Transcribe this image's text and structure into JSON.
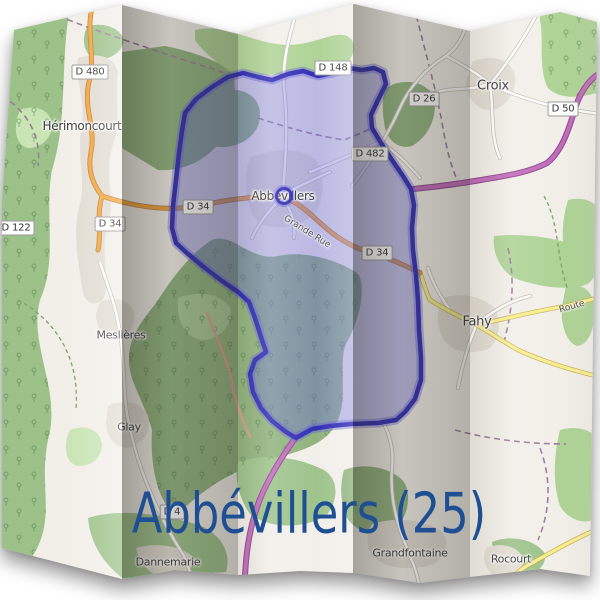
{
  "title": {
    "text": "Abbévillers (25)",
    "color": "#1f4f93"
  },
  "map": {
    "towns": [
      {
        "name": "Hérimoncourt",
        "x": 82,
        "y": 126,
        "size": 12
      },
      {
        "name": "Croix",
        "x": 493,
        "y": 86,
        "size": 13
      },
      {
        "name": "Abbévillers",
        "x": 283,
        "y": 196,
        "size": 12
      },
      {
        "name": "Meslières",
        "x": 121,
        "y": 335,
        "size": 11
      },
      {
        "name": "Glay",
        "x": 129,
        "y": 427,
        "size": 11
      },
      {
        "name": "Fahy",
        "x": 477,
        "y": 322,
        "size": 13
      },
      {
        "name": "Grandfontaine",
        "x": 410,
        "y": 553,
        "size": 11
      },
      {
        "name": "Rocourt",
        "x": 511,
        "y": 559,
        "size": 11
      },
      {
        "name": "Dannemarie",
        "x": 168,
        "y": 562,
        "size": 11
      }
    ],
    "road_refs": [
      {
        "text": "D 480",
        "x": 90,
        "y": 72
      },
      {
        "text": "D 148",
        "x": 333,
        "y": 68
      },
      {
        "text": "D 26",
        "x": 424,
        "y": 99
      },
      {
        "text": "D 50",
        "x": 563,
        "y": 109
      },
      {
        "text": "D 482",
        "x": 370,
        "y": 154
      },
      {
        "text": "D 122",
        "x": 16,
        "y": 228
      },
      {
        "text": "D 34",
        "x": 110,
        "y": 224
      },
      {
        "text": "D 34",
        "x": 198,
        "y": 207
      },
      {
        "text": "D 34",
        "x": 377,
        "y": 253
      },
      {
        "text": "D 4",
        "x": 172,
        "y": 512
      }
    ],
    "street_names": [
      {
        "text": "Grande Rue",
        "x": 307,
        "y": 232,
        "angle": 32
      },
      {
        "text": "Route",
        "x": 572,
        "y": 307,
        "angle": -16
      }
    ],
    "marker": {
      "x": 284,
      "y": 196
    },
    "colors": {
      "commune_stroke": "#2f2bb4",
      "commune_glow": "rgba(95,90,220,0.40)",
      "commune_fill": "rgba(95,95,215,0.38)",
      "border_road": "#c06ab8",
      "primary_road": "#f2a43c",
      "yellow_road": "#f7ef8e",
      "forest": "#9cc289",
      "base": "#f2efe9"
    }
  }
}
